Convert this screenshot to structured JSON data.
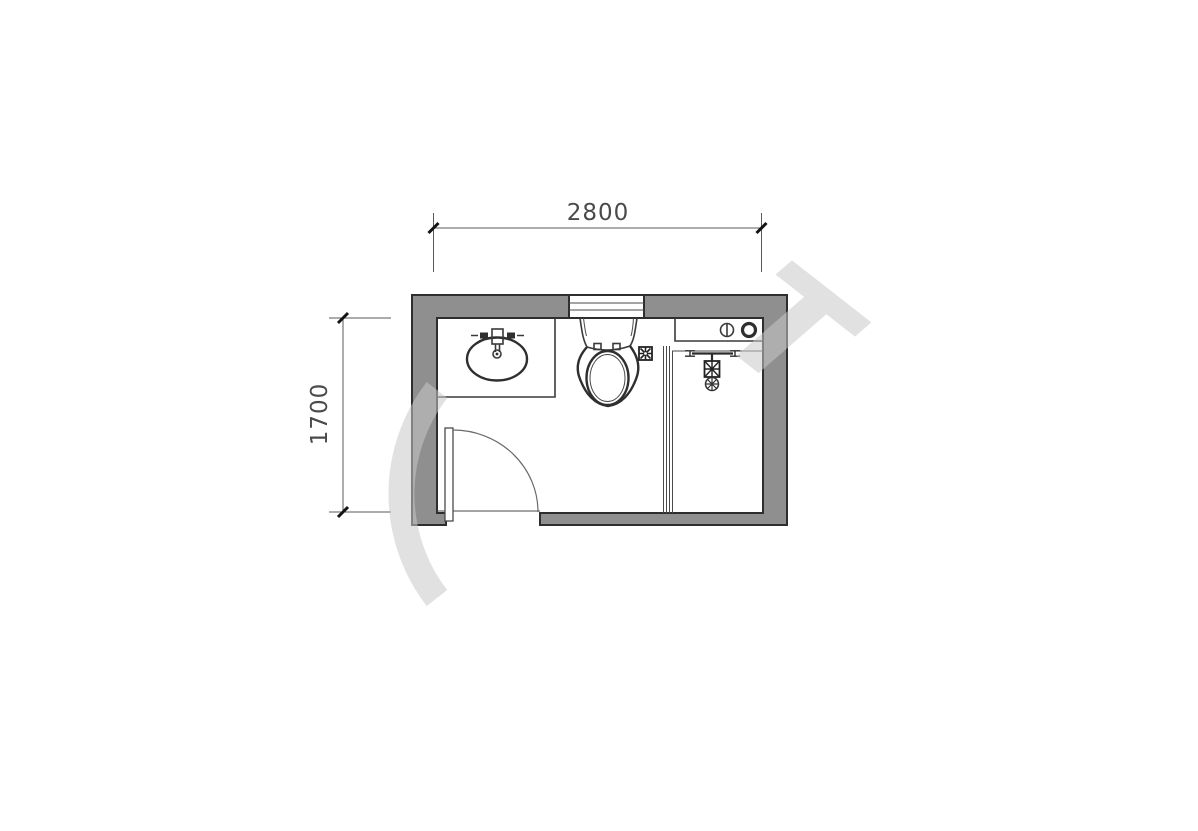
{
  "plan": {
    "type": "bathroom-floor-plan",
    "dimensions": {
      "width": "2800",
      "depth": "1700"
    },
    "colors": {
      "background": "#ffffff",
      "wall_fill": "#8f8f8f",
      "wall_outline": "#2e2e2e",
      "fixture_line": "#3a3a3a",
      "dimension_line": "#5a5a5a",
      "dimension_text": "#4a4a4a",
      "tick": "#141414",
      "watermark": "#c9c9c9"
    },
    "fixtures": [
      {
        "name": "vanity-counter-with-oval-sink"
      },
      {
        "name": "faucet"
      },
      {
        "name": "toilet"
      },
      {
        "name": "floor-drain"
      },
      {
        "name": "window"
      },
      {
        "name": "door-with-swing-arc"
      },
      {
        "name": "washer-shelf-with-knobs"
      },
      {
        "name": "shower-glass-partition"
      },
      {
        "name": "shower-head"
      }
    ],
    "watermark_letter": "T"
  }
}
